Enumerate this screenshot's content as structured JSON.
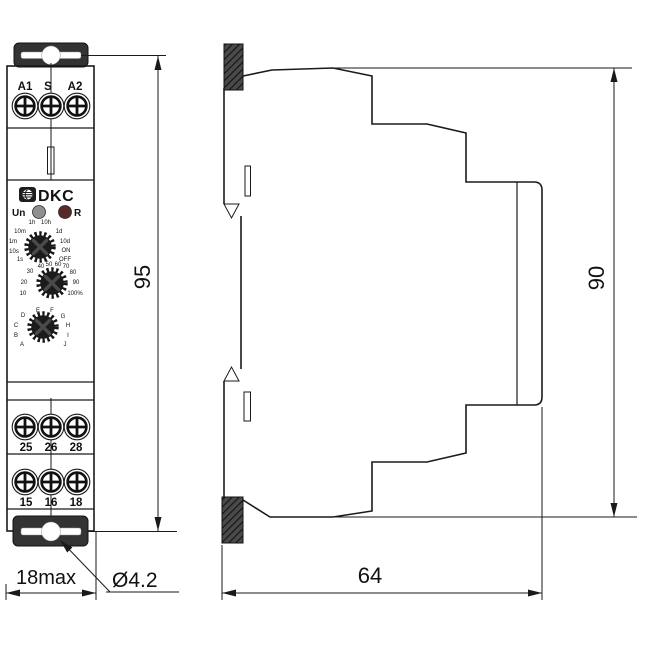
{
  "front": {
    "top_terminals": [
      "A1",
      "S",
      "A2"
    ],
    "brand": "DKC",
    "leds": {
      "left_label": "Un",
      "right_label": "R"
    },
    "dial_time": [
      "1h",
      "10h",
      "10m",
      "1m",
      "10s",
      "1s",
      "1d",
      "10d",
      "ON",
      "OFF"
    ],
    "dial_percent": [
      "40",
      "50",
      "60",
      "70",
      "30",
      "20",
      "10",
      "80",
      "90",
      "100%"
    ],
    "dial_function": [
      "E",
      "F",
      "D",
      "G",
      "C",
      "H",
      "B",
      "I",
      "A",
      "J"
    ],
    "mid_terminals": [
      "25",
      "26",
      "28"
    ],
    "bottom_terminals": [
      "15",
      "16",
      "18"
    ]
  },
  "dimensions": {
    "front_height": "95",
    "side_height": "90",
    "front_width": "18max",
    "side_depth": "64",
    "hole_diameter": "Ø4.2"
  },
  "colors": {
    "led_un": "#8f8f8f",
    "led_r": "#5a2a2a",
    "clip": "#3a3a3a",
    "knob": "#1b1b1b"
  }
}
